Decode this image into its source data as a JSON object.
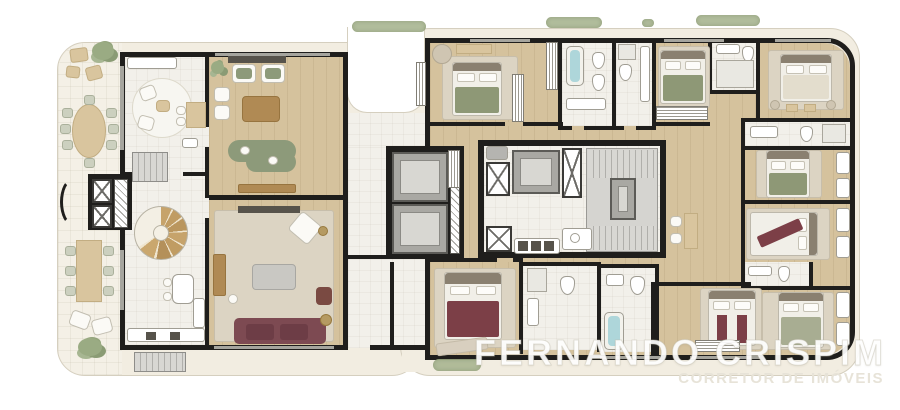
{
  "watermark": {
    "line1": "FERNANDO CRISPIM",
    "line2": "CORRETOR DE IMÓVEIS"
  },
  "palette": {
    "page_bg": "#ffffff",
    "footprint": "#f2ede1",
    "footprint_edge": "#d5cfbf",
    "terrace": "#f4f0e6",
    "tile": "#f2f0ea",
    "wood_floor": "#d5c29d",
    "wall": "#1f1e1c",
    "stair_gray": "#d5d4d0",
    "elevator_gray": "#a9a8a3",
    "rug_beige": "#dcd4c3",
    "bed_green": "#8e9876",
    "bed_burgundy": "#7c3f47",
    "sofa_burgundy": "#7d4a52",
    "sofa_green": "#8d9a7a",
    "wood_furniture": "#b08a54",
    "tub_blue": "#aed6da",
    "plant_green": "#9aab83",
    "watermark_white": "rgba(255,255,255,0.92)",
    "watermark_sub": "#e7e3d8"
  },
  "plan": {
    "type": "residential-floor-plan",
    "areas": [
      "terrace",
      "dining-terrace",
      "lounge-terrace",
      "breakfast-room",
      "upper-living-room",
      "lower-living-room",
      "kitchen",
      "spiral-staircase",
      "service-stair",
      "private-elevator-lobby",
      "entry",
      "foyer",
      "elevator-core",
      "service-core",
      "stairwell",
      "service-area",
      "corridor",
      "master-suite",
      "master-bathroom",
      "bathroom",
      "suite",
      "wardrobe",
      "study-nook"
    ],
    "furniture_types": [
      "bed",
      "rug",
      "sofa",
      "armchair",
      "dining-table",
      "chair",
      "coffee-table",
      "sideboard",
      "console",
      "bench",
      "desk",
      "toilet",
      "sink",
      "bathtub",
      "shower",
      "wardrobe",
      "plant",
      "hedge",
      "pouf",
      "stool"
    ]
  }
}
